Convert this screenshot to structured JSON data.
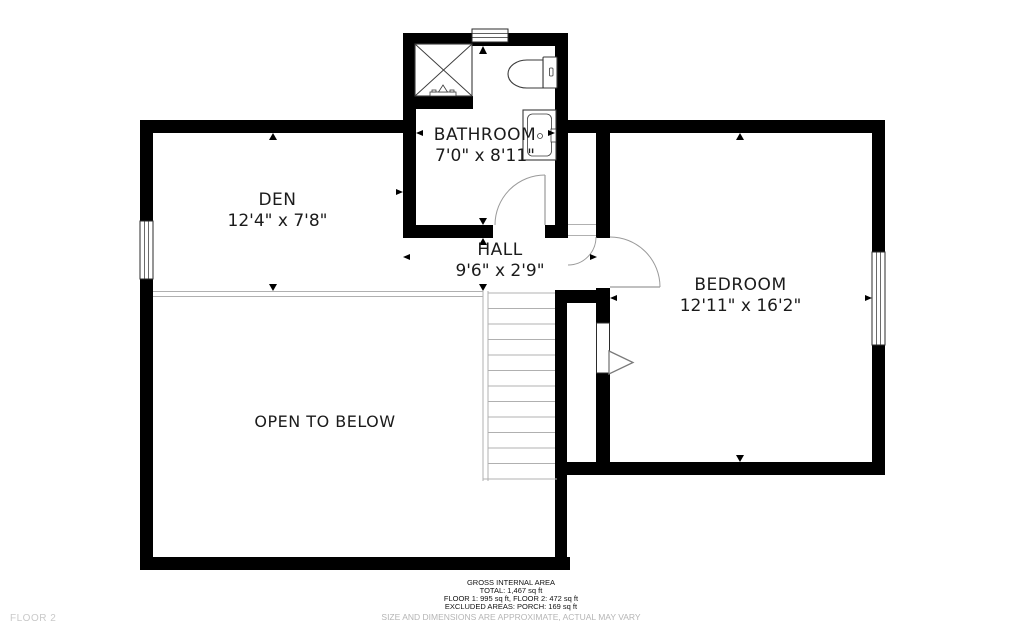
{
  "floor_label": "FLOOR 2",
  "rooms": [
    {
      "name": "BATHROOM",
      "dimensions": "7'0\" x 8'11\""
    },
    {
      "name": "DEN",
      "dimensions": "12'4\" x 7'8\""
    },
    {
      "name": "HALL",
      "dimensions": "9'6\" x 2'9\""
    },
    {
      "name": "BEDROOM",
      "dimensions": "12'11\" x 16'2\""
    },
    {
      "name": "OPEN TO BELOW",
      "dimensions": ""
    }
  ],
  "footer": {
    "title": "GROSS INTERNAL AREA",
    "total": "TOTAL: 1,467 sq ft",
    "floors": "FLOOR 1: 995 sq ft, FLOOR 2: 472 sq ft",
    "excluded": "EXCLUDED AREAS: PORCH: 169 sq ft",
    "disclaimer": "SIZE AND DIMENSIONS ARE APPROXIMATE, ACTUAL MAY VARY"
  },
  "fixtures": [
    "shower-icon",
    "toilet-icon",
    "sink-icon",
    "staircase",
    "door-swing",
    "window",
    "stairs-direction-arrow",
    "dimension-arrow"
  ],
  "colors": {
    "wall": "#000000",
    "thin_line": "#b0b0b0",
    "door_arc": "#9a9a9a",
    "text": "#1b1b1b",
    "muted_text": "#b5b5b5",
    "background": "#ffffff"
  }
}
